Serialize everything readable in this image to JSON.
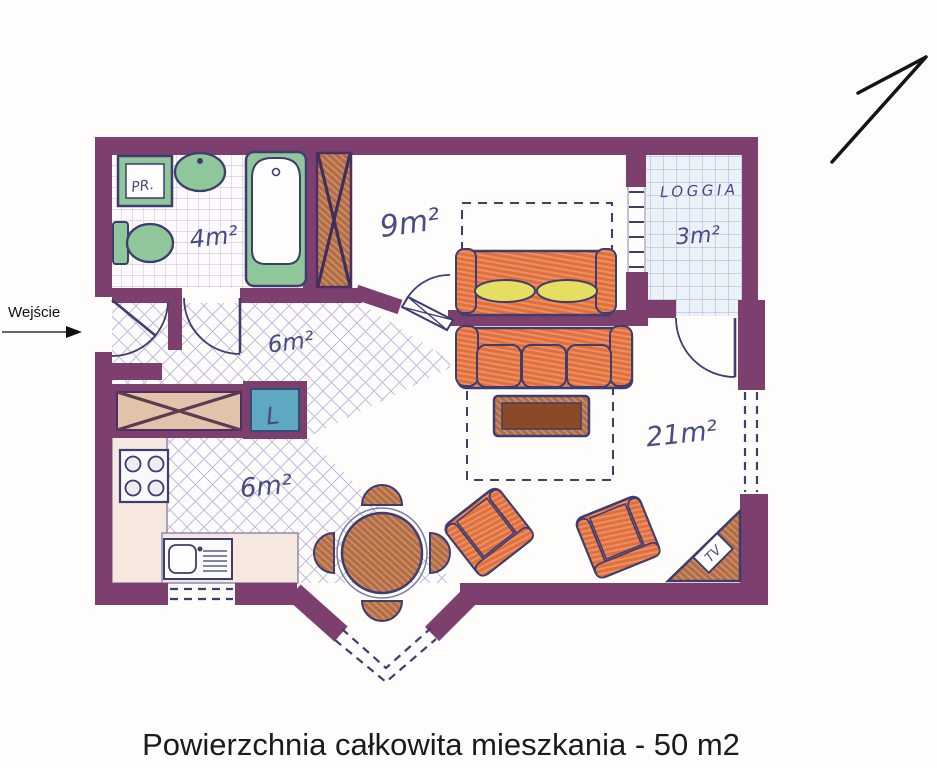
{
  "caption": "Powierzchnia całkowita mieszkania - 50 m2",
  "entrance": {
    "label": "Wejście"
  },
  "rooms": {
    "bathroom": {
      "area": "4m²"
    },
    "bedroom": {
      "area": "9m²"
    },
    "hall": {
      "area": "6m²"
    },
    "kitchen": {
      "area": "6m²"
    },
    "living": {
      "area": "21m²"
    },
    "loggia": {
      "name": "LOGGIA",
      "area": "3m²"
    }
  },
  "appliances": {
    "washer": "PR.",
    "fridge": "L",
    "tv": "TV"
  },
  "colors": {
    "wall": "#7d3f6e",
    "ink": "#3d3d70",
    "label-ink": "#4a4a85",
    "orange": "#e0713f",
    "orange-light": "#ef9468",
    "brown": "#b26c46",
    "brown-light": "#cd9268",
    "brown-dark": "#8a4a26",
    "green": "#8fc79a",
    "teal": "#5fa8c2",
    "yellow": "#e6de60",
    "counter": "#f6e7df",
    "hatch": "#9d9dc9",
    "bath-grid": "#c9b9d6",
    "loggia-grid": "#9fb2d4"
  }
}
